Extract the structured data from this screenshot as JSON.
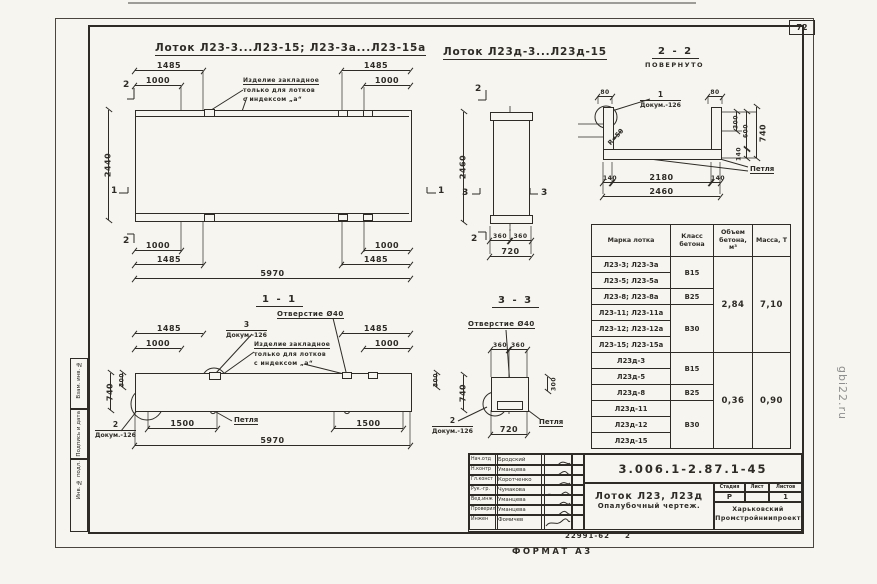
{
  "page": {
    "number": "72",
    "watermark": "gbi22.ru",
    "format_label": "ФОРМАТ А3",
    "footer_code": "22991-62",
    "footer_sheet": "2"
  },
  "margin_labels": {
    "vzam": "Взам. инв. №",
    "podpis": "Подпись и дата",
    "inv": "Инв. № подл."
  },
  "titles": {
    "left": "Лоток Л23-3...Л23-15; Л23-3а...Л23-15а",
    "mid": "Лоток Л23д-3...Л23д-15",
    "sec22": "2 - 2",
    "sec22_sub": "ПОВЕРНУТО",
    "sec11": "1 - 1",
    "sec33": "3 - 3"
  },
  "notes": {
    "embed1": "Изделие закладное",
    "embed2": "только для лотков",
    "embed3": "с индексом „а“",
    "hole": "Отверстие Ø40",
    "loop": "Петля",
    "doc": "Докум.-126",
    "callout1": "1",
    "callout2": "2",
    "callout3": "3",
    "radius": "R=50"
  },
  "plan": {
    "d1485": "1485",
    "d1000": "1000",
    "d2440": "2440",
    "d5970": "5970",
    "m1": "1",
    "m2": "2"
  },
  "end_view": {
    "d2460": "2460",
    "d360": "360",
    "d720": "720",
    "m2": "2",
    "m3": "3"
  },
  "sec22": {
    "d80": "80",
    "d300": "300",
    "d600": "600",
    "d140": "140",
    "d740": "740",
    "d2180": "2180",
    "d2460": "2460"
  },
  "sec11": {
    "d1485": "1485",
    "d1000": "1000",
    "d740": "740",
    "d300": "300",
    "d1500": "1500",
    "d5970": "5970"
  },
  "sec33": {
    "d360": "360",
    "d740": "740",
    "d300": "300",
    "d720": "720"
  },
  "table": {
    "headers": [
      "Марка\nлотка",
      "Класс\nбетона",
      "Объем\nбетона,\nм³",
      "Масса,\nТ"
    ],
    "rows": [
      {
        "mark": "Л23-3; Л23-3а",
        "cls": "В15"
      },
      {
        "mark": "Л23-5; Л23-5а"
      },
      {
        "mark": "Л23-8; Л23-8а",
        "cls": "В25"
      },
      {
        "mark": "Л23-11; Л23-11а",
        "cls": "В30"
      },
      {
        "mark": "Л23-12; Л23-12а"
      },
      {
        "mark": "Л23-15; Л23-15а"
      },
      {
        "mark": "Л23д-3",
        "cls": "В15"
      },
      {
        "mark": "Л23д-5"
      },
      {
        "mark": "Л23д-8",
        "cls": "В25"
      },
      {
        "mark": "Л23д-11",
        "cls": "В30"
      },
      {
        "mark": "Л23д-12"
      },
      {
        "mark": "Л23д-15"
      }
    ],
    "volume1": "2,84",
    "mass1": "7,10",
    "volume2": "0,36",
    "mass2": "0,90"
  },
  "titleblock": {
    "doc_number": "3.006.1-2.87.1-45",
    "product1": "Лоток Л23, Л23д",
    "product2": "Опалубочный чертеж.",
    "org1": "Харьковский",
    "org2": "Промстройниипроект",
    "stage_headers": [
      "Стадия",
      "Лист",
      "Листов"
    ],
    "stage": "Р",
    "sheet": "",
    "sheets": "1",
    "signers": [
      {
        "role": "Нач.отд",
        "name": "Бродский"
      },
      {
        "role": "Н.контр",
        "name": "Уманцева"
      },
      {
        "role": "Гл.конст",
        "name": "Коротченко"
      },
      {
        "role": "Рук.-гр.",
        "name": "Чумакова"
      },
      {
        "role": "Вед.инж",
        "name": "Уманцева"
      },
      {
        "role": "Проверил",
        "name": "Уманцева"
      },
      {
        "role": "Инжен",
        "name": "Фомичев"
      }
    ]
  }
}
